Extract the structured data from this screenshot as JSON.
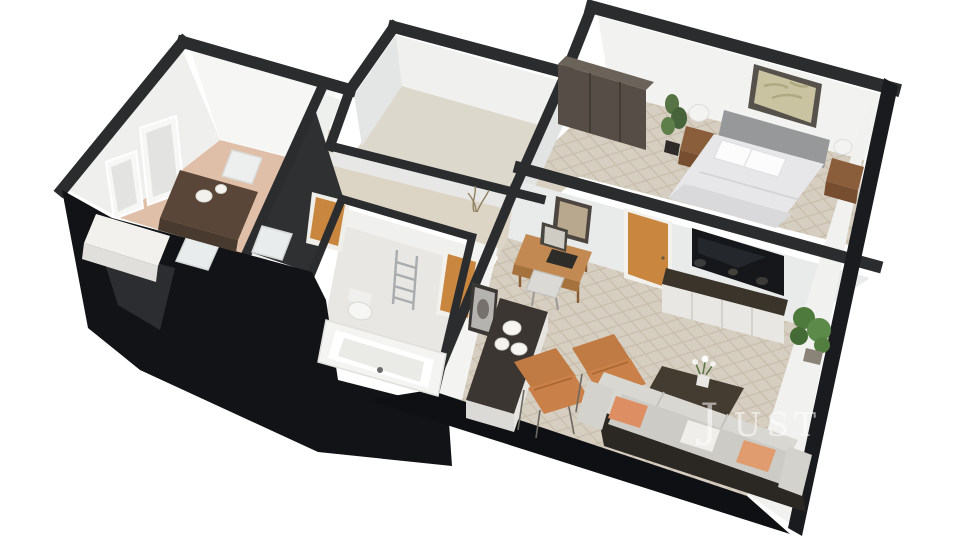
{
  "watermark": {
    "text": "Justo",
    "parts": [
      "J",
      "UST",
      "O"
    ]
  },
  "colors": {
    "background": "#ffffff",
    "wall_cap": "#2b2c2e",
    "wall_face_light": "#f4f4f2",
    "wall_face_shade": "#e2e4e3",
    "facade_black": "#121316",
    "facade_black_bottom": "#0f1013",
    "facade_black_right": "#1a1b1e",
    "floor_wood": "#d6cec0",
    "floor_wood_line": "#c6bcab",
    "floor_dining": "#e0bfa8",
    "floor_hall": "#dcd5c6",
    "floor_bath": "#e9e7e3",
    "floor_empty_room": "#ddd8cc",
    "door_orange": "#c8863f",
    "chair_orange": "#c07a44",
    "sofa_light": "#d8d7d2",
    "sofa_base_dark": "#2b2824",
    "pillow_salmon": "#dd8f63",
    "wood_dark": "#5a4638",
    "wardrobe_brown": "#564e46",
    "tv_black": "#15171a",
    "plant_green": "#557343",
    "watermark_white": "#ffffff"
  },
  "scene": {
    "type": "3d-floorplan-cutaway-render",
    "view": "isometric",
    "rooms": [
      {
        "name": "dining-room",
        "items": [
          "dining-table",
          "dining-chairs",
          "table-vases",
          "window-frames",
          "kitchen-counter"
        ]
      },
      {
        "name": "second-bedroom",
        "items": []
      },
      {
        "name": "hallway",
        "items": [
          "dried-plant",
          "wc-door"
        ]
      },
      {
        "name": "bathroom",
        "items": [
          "bathtub",
          "toilet",
          "towel-ladder",
          "bathroom-door"
        ]
      },
      {
        "name": "living-room",
        "items": [
          "tv",
          "tv-console",
          "sofa",
          "accent-pillows",
          "lounge-chairs",
          "coffee-table",
          "sideboard",
          "jug-vases",
          "desk",
          "desk-stool",
          "wall-art",
          "corner-plant",
          "bedroom-door"
        ]
      },
      {
        "name": "bedroom",
        "items": [
          "double-bed",
          "headboard",
          "nightstands",
          "table-lamps",
          "wall-art",
          "potted-plant",
          "wardrobe"
        ]
      }
    ]
  }
}
